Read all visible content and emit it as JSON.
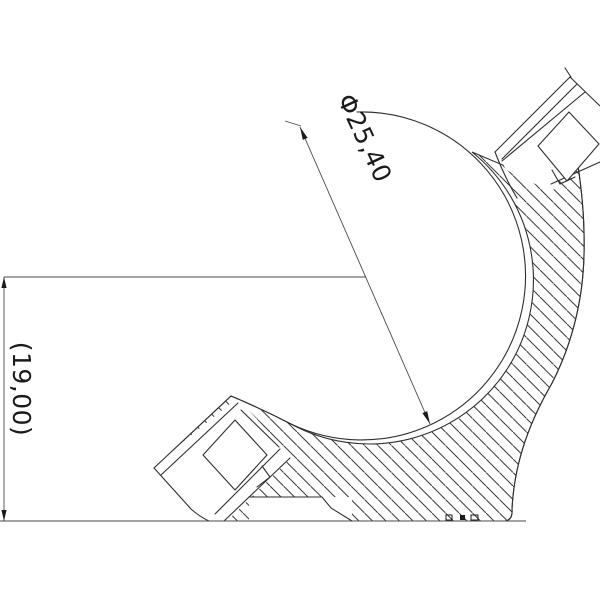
{
  "page": {
    "background": "#ffffff",
    "line_color": "#2f2f2f",
    "hatch_color": "#3a3a3a",
    "text_color": "#1a1a1a"
  },
  "annotations": {
    "diameter_label": "Φ25,40",
    "height_label": "(19,00)"
  }
}
